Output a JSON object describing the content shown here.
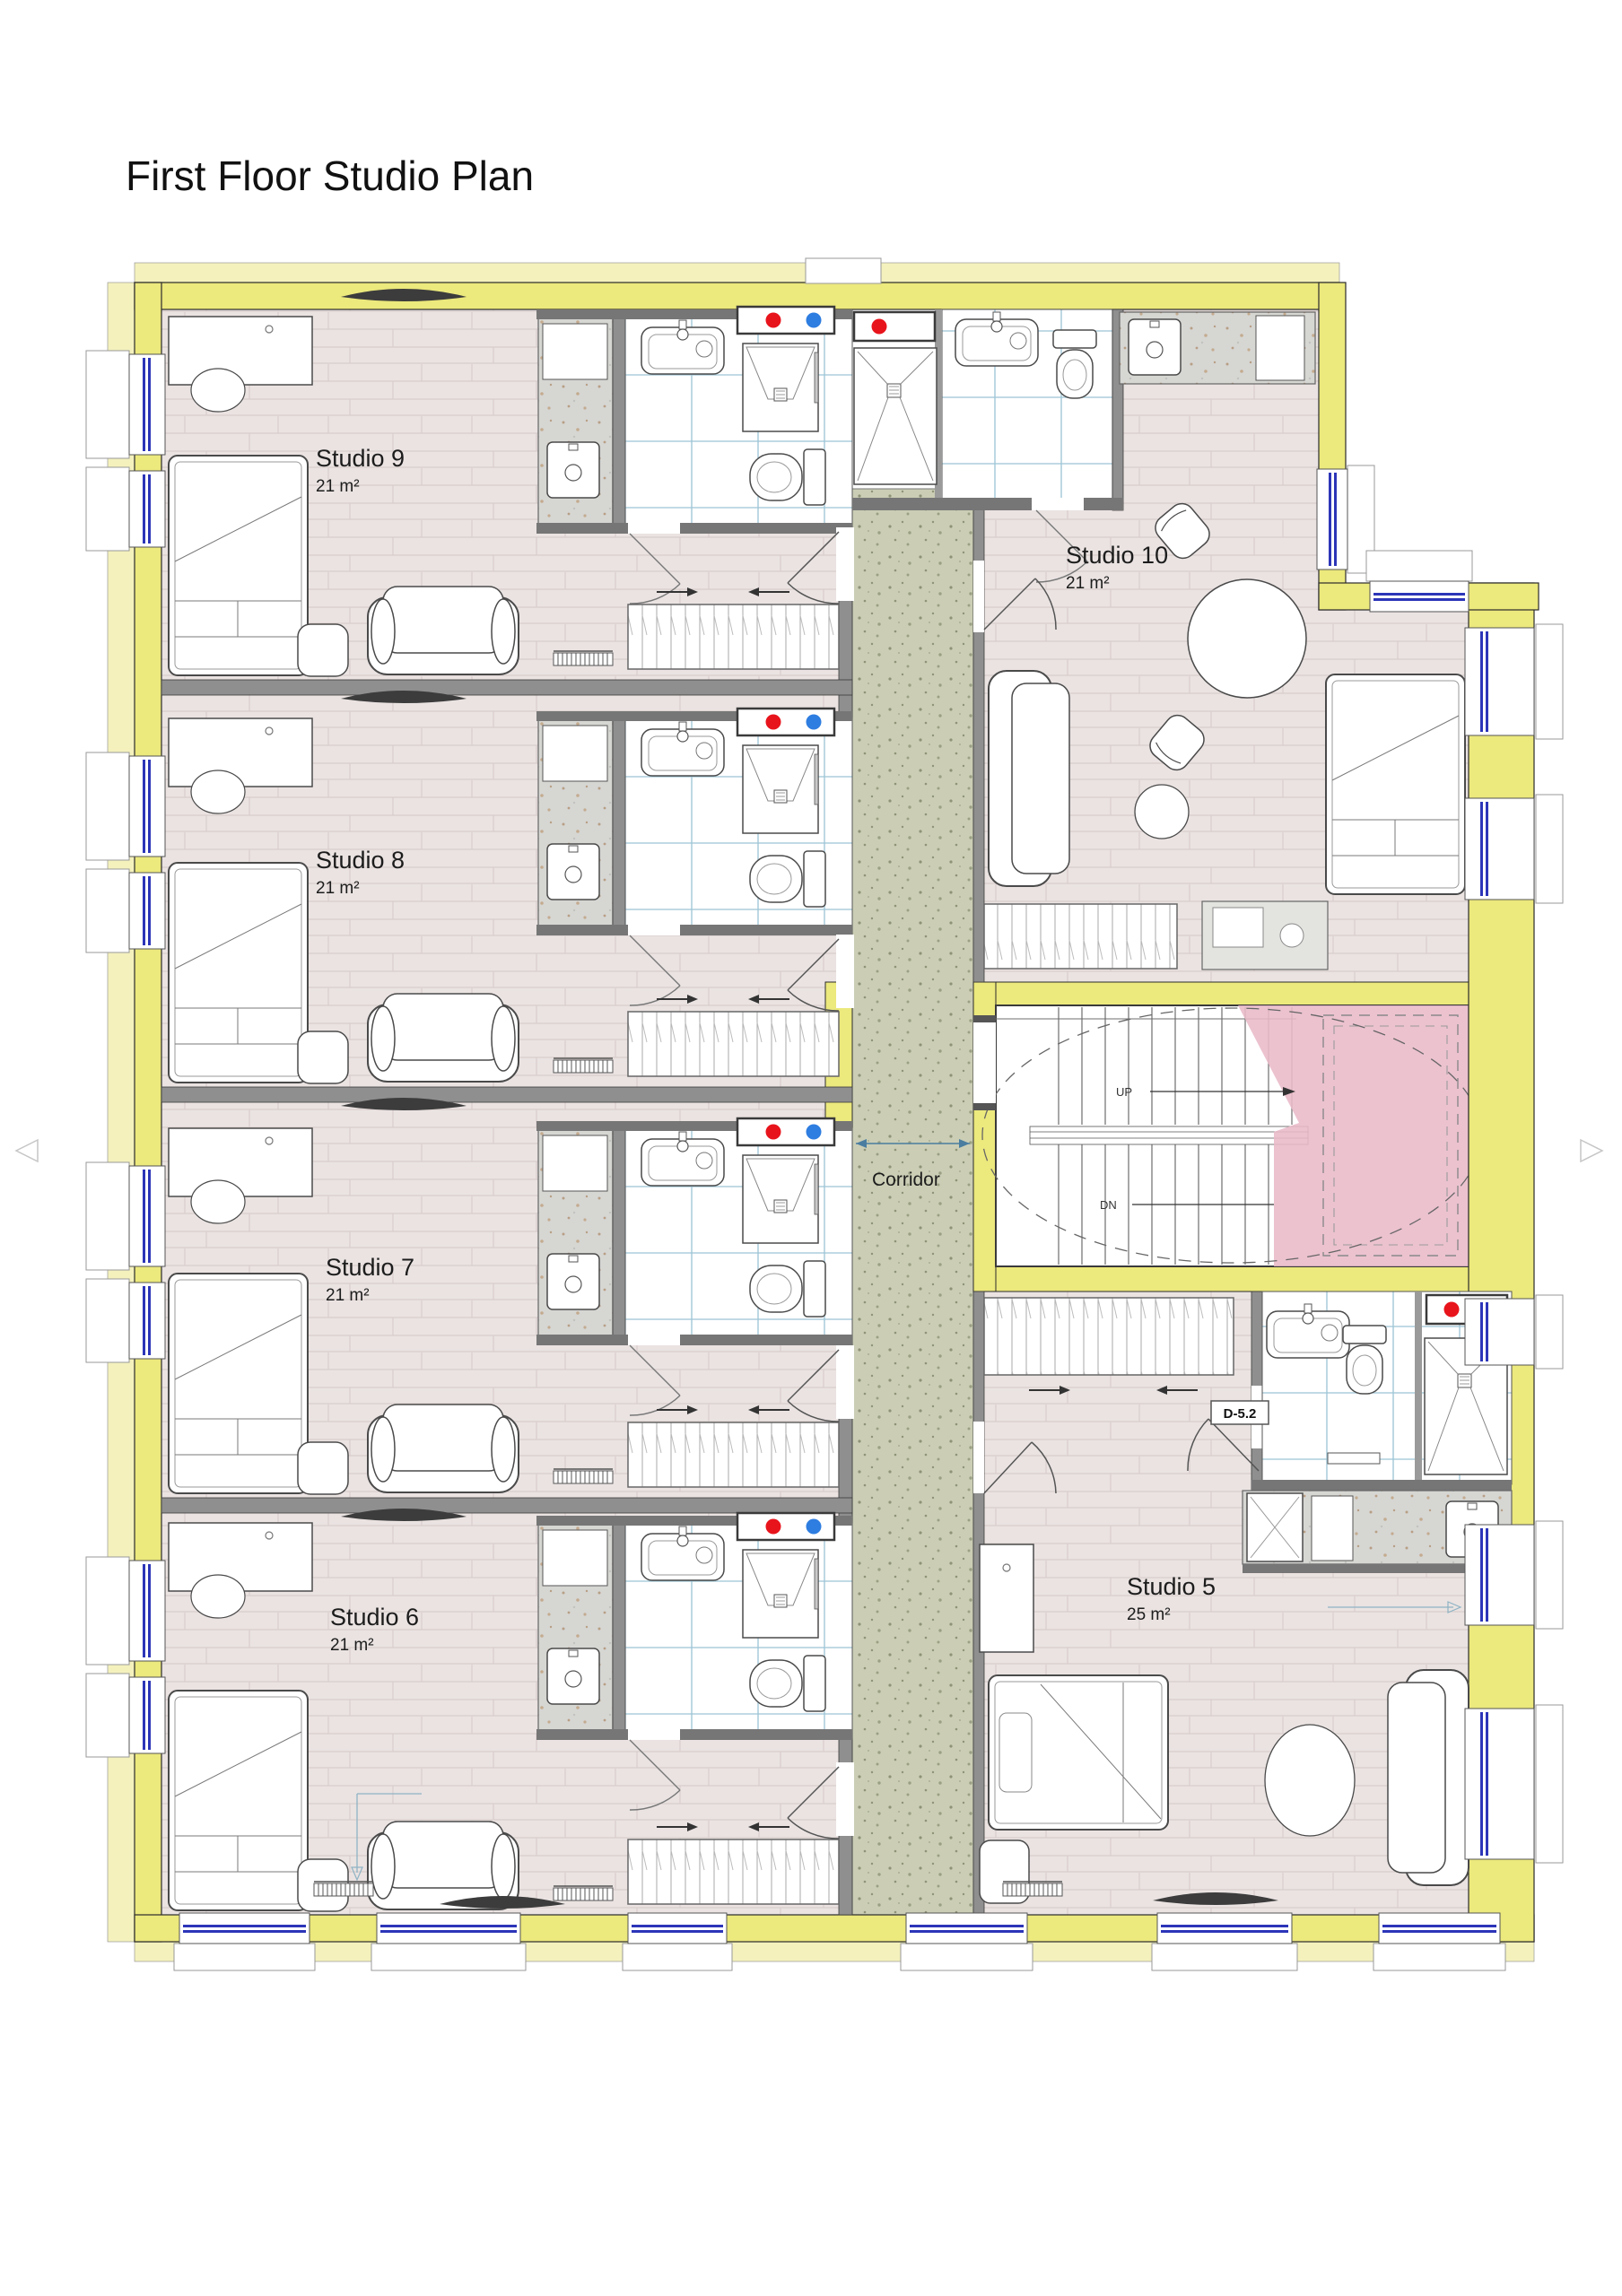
{
  "page": {
    "title": "First Floor Studio Plan"
  },
  "rooms": {
    "studio9": {
      "name": "Studio 9",
      "area": "21 m²"
    },
    "studio8": {
      "name": "Studio 8",
      "area": "21 m²"
    },
    "studio7": {
      "name": "Studio 7",
      "area": "21 m²"
    },
    "studio6": {
      "name": "Studio 6",
      "area": "21 m²"
    },
    "studio10": {
      "name": "Studio 10",
      "area": "21 m²"
    },
    "studio5": {
      "name": "Studio 5",
      "area": "25 m²"
    },
    "corridor": {
      "name": "Corridor"
    }
  },
  "stair": {
    "up": "UP",
    "down": "DN"
  },
  "door_tags": {
    "studio5_bathroom": "D-5.2"
  },
  "icons": {
    "hot_water_dot": "hot-water-supply",
    "cold_water_dot": "cold-water-supply"
  },
  "colors": {
    "exterior_wall": "#ece97d",
    "exterior_wall_pale": "#f4f1bd",
    "interior_wall": "#8f8f8f",
    "wall_band": "#767676",
    "room_floor": "#eae3e2",
    "corridor_floor": "#cbceb5",
    "bathroom_tile_line": "#9cc4d6",
    "counter": "#d6d6d3",
    "stair_highlight": "#e9b9c8",
    "hot_water": "#e8141c",
    "cold_water": "#2e7de0",
    "window_glazing": "#2c35b8"
  }
}
